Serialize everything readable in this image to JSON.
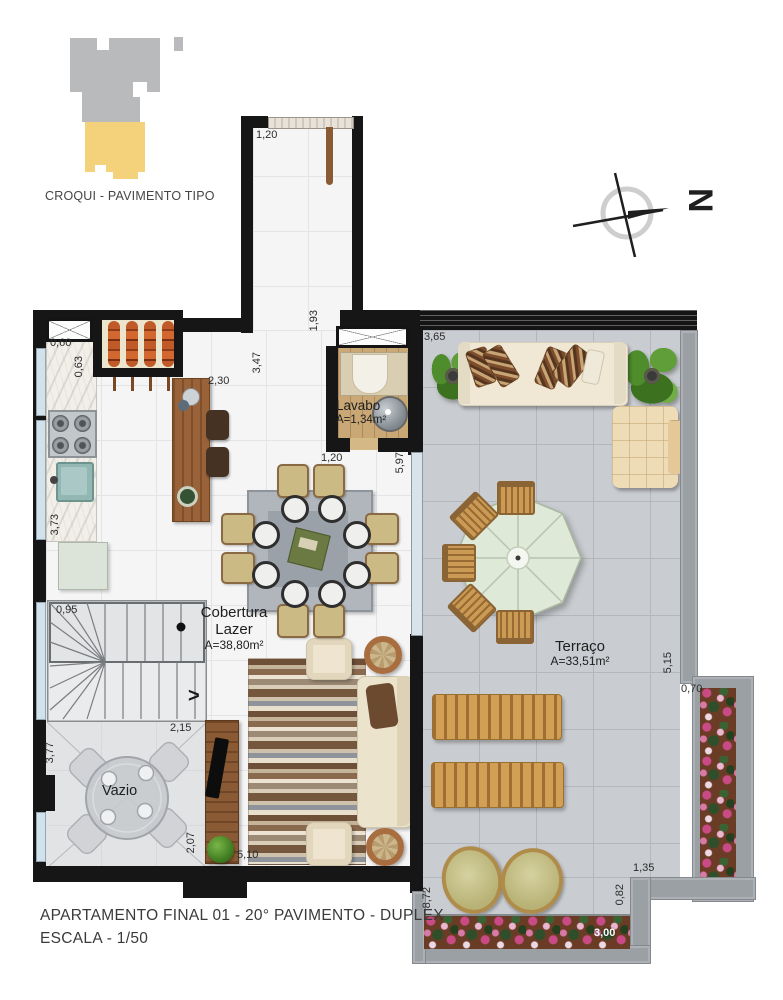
{
  "colors": {
    "wall": "#161616",
    "unit_highlight": "#f4d27c",
    "building_gray": "#b9babc",
    "terrace_tile": "#c9ccd0",
    "interior_tile": "#f5f5f6",
    "planter_flowers": "#c94b86"
  },
  "croqui": {
    "caption": "CROQUI - PAVIMENTO TIPO"
  },
  "compass": {
    "label": "N"
  },
  "stairs": {
    "direction_arrow": ">"
  },
  "rooms": {
    "lavabo": {
      "name": "Lavabo",
      "area": "A=1,34m²"
    },
    "cobertura": {
      "line1": "Cobertura",
      "line2": "Lazer",
      "area": "A=38,80m²"
    },
    "terraco": {
      "name": "Terraço",
      "area": "A=33,51m²"
    },
    "vazio": {
      "name": "Vazio"
    }
  },
  "dims": {
    "corridor_width": "1,20",
    "corridor_length": "1,93",
    "hall_length": "3,47",
    "counter_length": "2,30",
    "grill_offset": "0,60",
    "grill_depth": "0,63",
    "kitchen_length": "3,73",
    "stair_width": "0,95",
    "vazio_height": "3,77",
    "vazio_width": "2,15",
    "vazio_depth": "2,07",
    "living_width": "5,10",
    "lavabo_width": "1,20",
    "interior_depth": "5,97",
    "terrace_top_width": "3,65",
    "terrace_right_depth": "5,15",
    "planter_width": "0,70",
    "terrace_notch_width": "1,35",
    "terrace_depth": "8,72",
    "terrace_notch_depth": "0,82",
    "planter_length": "3,00"
  },
  "title_block": {
    "line1": "APARTAMENTO FINAL 01 - 20° PAVIMENTO - DUPLEX",
    "line2": "ESCALA - 1/50"
  }
}
